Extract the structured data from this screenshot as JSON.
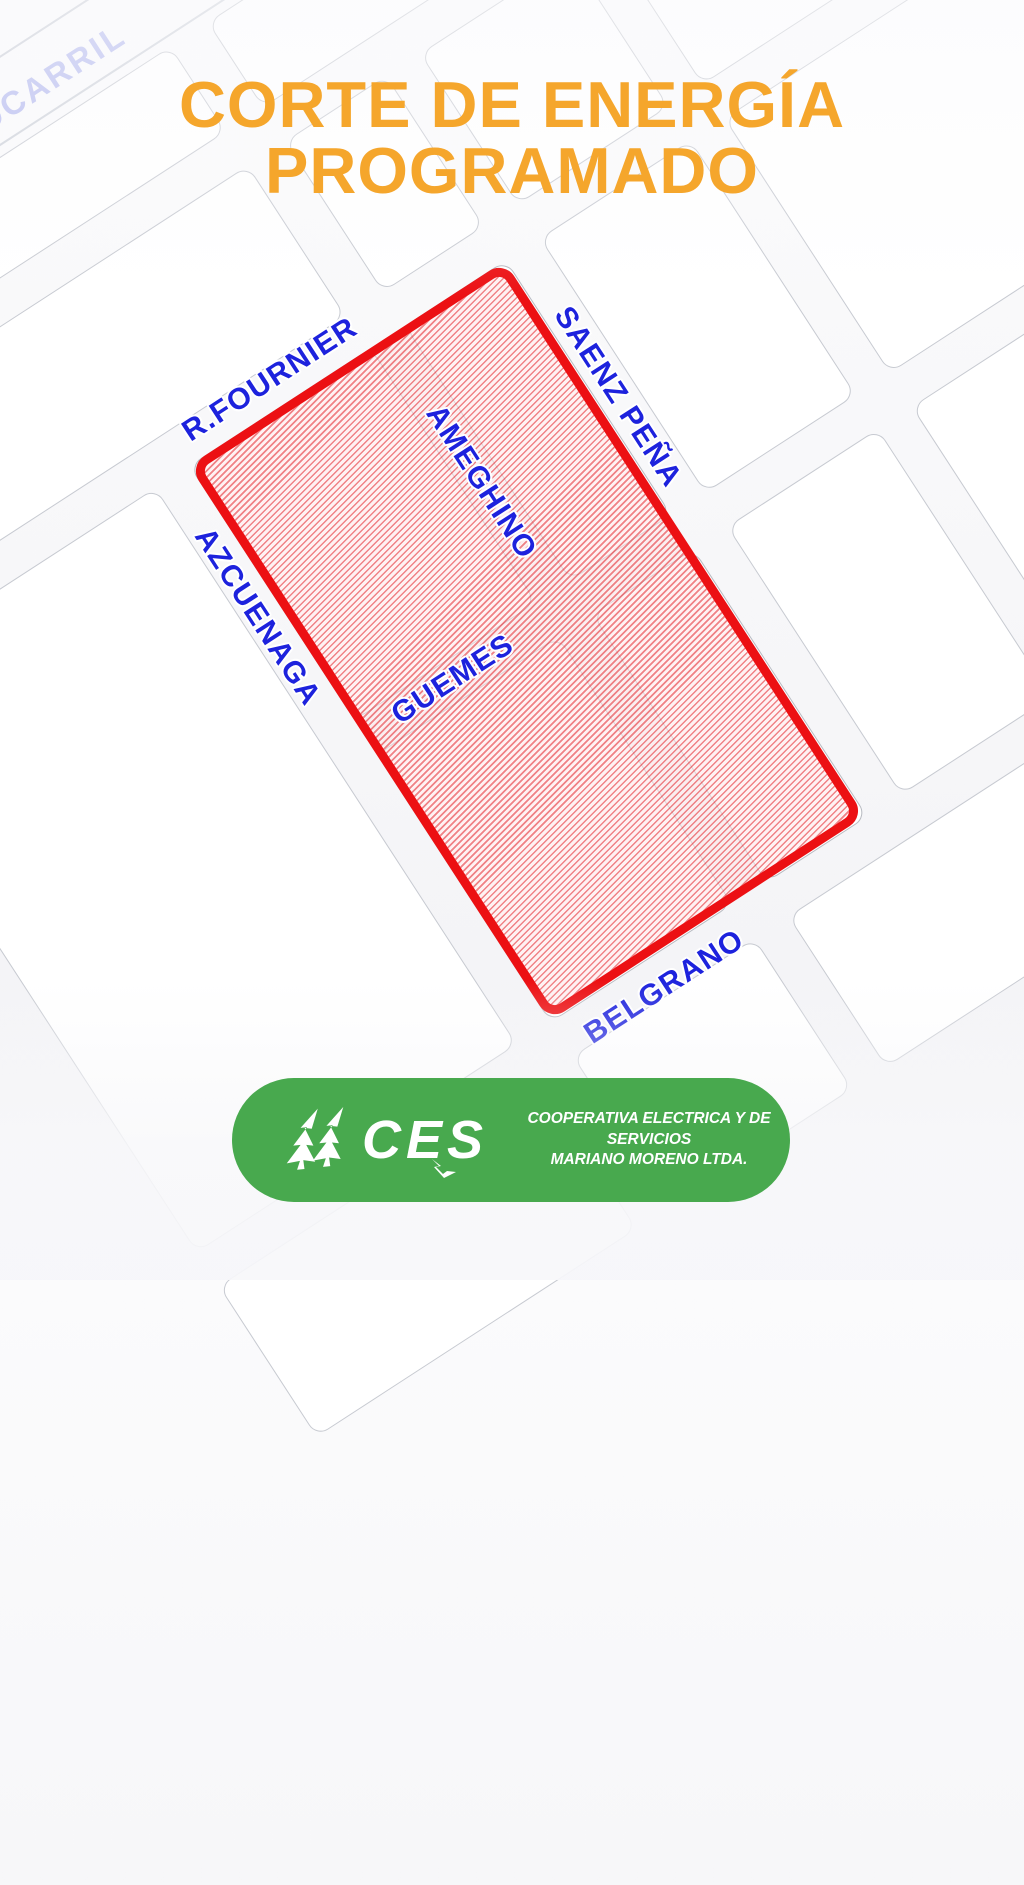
{
  "poster": {
    "title_line1": "CORTE DE ENERGÍA",
    "title_line2": "PROGRAMADO",
    "title_color": "#F5A62C"
  },
  "map": {
    "outage_zone": {
      "border_color": "#EC1013",
      "fill_pattern": "red-diagonal-hatch"
    },
    "street_label_color": "#1D22DD",
    "railway_label_color": "#B5BAEF",
    "streets": {
      "ferrocarril_partial": "OCARRIL",
      "r_fournier": "R.FOURNIER",
      "saenz_pena": "SAENZ PEÑA",
      "ameghino": "AMEGHINO",
      "azcuenaga": "AZCUENAGA",
      "guemes": "GUEMES",
      "belgrano": "BELGRANO"
    }
  },
  "footer": {
    "logo_acronym": "CES",
    "org_line1": "COOPERATIVA ELECTRICA Y DE SERVICIOS",
    "org_line2": "MARIANO MORENO LTDA.",
    "badge_color": "#48A94E"
  }
}
